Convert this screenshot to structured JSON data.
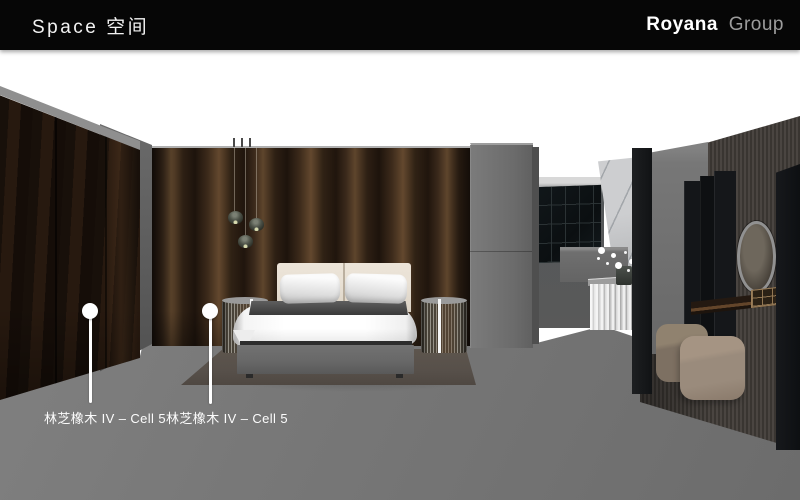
{
  "header": {
    "title": "Space 空间",
    "brand_primary": "Royana",
    "brand_secondary": "Group"
  },
  "render": {
    "description": "3D bedroom showroom rendering with dark oak panel walls, bed, wardrobes, vanity and ottomans",
    "callouts": [
      {
        "label": "林芝橡木 IV – Cell 5"
      },
      {
        "label": "林芝橡木 IV – Cell 5"
      }
    ]
  },
  "colors": {
    "page_bg": "#ffffff",
    "header_bg": "#060606",
    "header_text": "#f2f2f2",
    "brand_primary_color": "#ffffff",
    "brand_secondary_color": "#9c9c9c",
    "floor": "#787878",
    "wood_dark": "#20150d",
    "wood_mid": "#3d2b1b",
    "wood_light": "#5e452c",
    "wardrobe_dark": "#18100a",
    "headboard": "#e9e1d5",
    "duvet": "#ffffff",
    "blanket": "#4a4a4a",
    "bed_base": "#686868",
    "rug": "#57504a",
    "marble": "#cdced0",
    "ottoman": "#9a8b7c",
    "callout_white": "#ffffff"
  }
}
